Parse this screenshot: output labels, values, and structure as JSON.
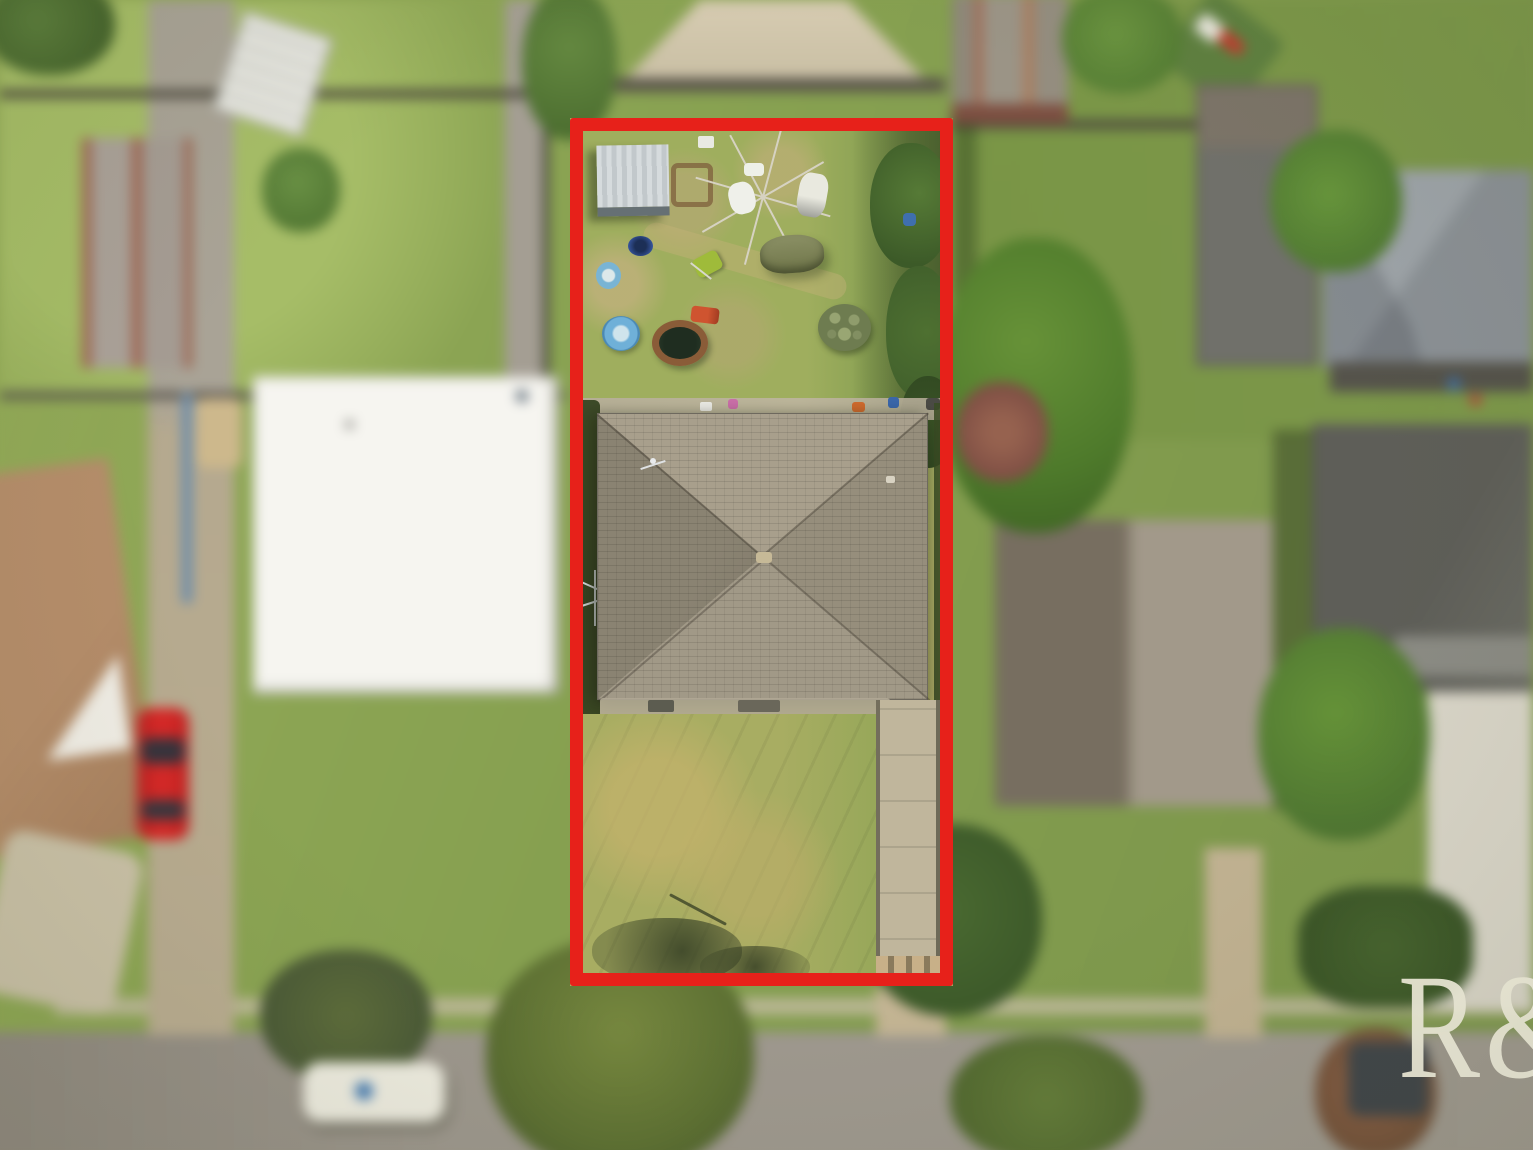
{
  "watermark": {
    "text": "R&",
    "color": "#f1eedd"
  },
  "boundary": {
    "color": "#e7211a"
  }
}
